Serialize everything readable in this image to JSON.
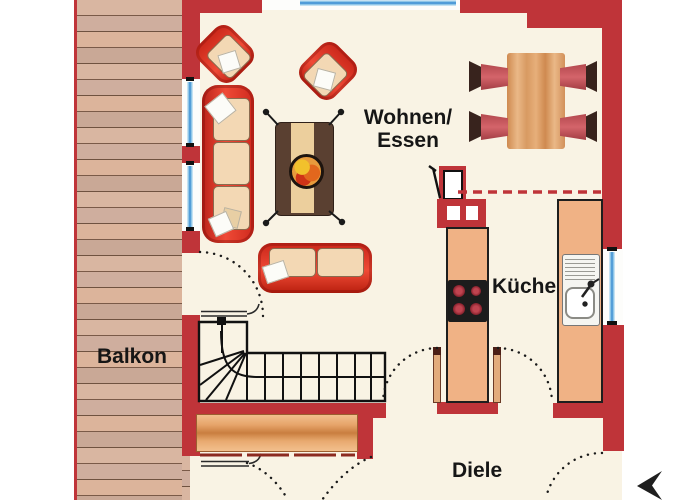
{
  "plan_type": "apartment-floor-plan",
  "labels": {
    "living1": "Wohnen/",
    "living2": "Essen",
    "kitchen": "Küche",
    "balcony": "Balkon",
    "hallway": "Diele"
  },
  "rooms": [
    {
      "name": "Wohnen/Essen",
      "furniture": [
        "sofa-3-seat",
        "sofa-2-seat",
        "armchair",
        "armchair",
        "coffee-table-with-fruit-bowl",
        "dining-table",
        "dining-chair-x4"
      ]
    },
    {
      "name": "Küche",
      "furniture": [
        "cooktop-counter",
        "sink-counter",
        "chimney-block"
      ]
    },
    {
      "name": "Balkon",
      "furniture": [
        "wood-plank-deck"
      ]
    },
    {
      "name": "Diele",
      "furniture": [
        "winder-staircase",
        "sideboard"
      ]
    }
  ],
  "symbols": {
    "entrance_arrow": "left-pointing-triangle",
    "door_swings": 6,
    "stair_direction_marks": 2,
    "open_plan_divider": "red-dashed-line"
  },
  "colors": {
    "wall-red": "#bf3439",
    "furniture-red": "#e03226",
    "furniture-red-dark": "#9a1c14",
    "cushion": "#f3d8b4",
    "counter-wood": "#f0b285",
    "table-wood": "#d6935b",
    "coffee-table": "#5a4031",
    "runner": "#eccf9d",
    "floor": "#f9f3e4",
    "balcony-wood": "#d2ad99",
    "window-blue": "#5fa8da",
    "chair-dark": "#38231d",
    "chair-seat": "#c4565a",
    "sideboard": "#dd9557",
    "ink": "#161616"
  }
}
